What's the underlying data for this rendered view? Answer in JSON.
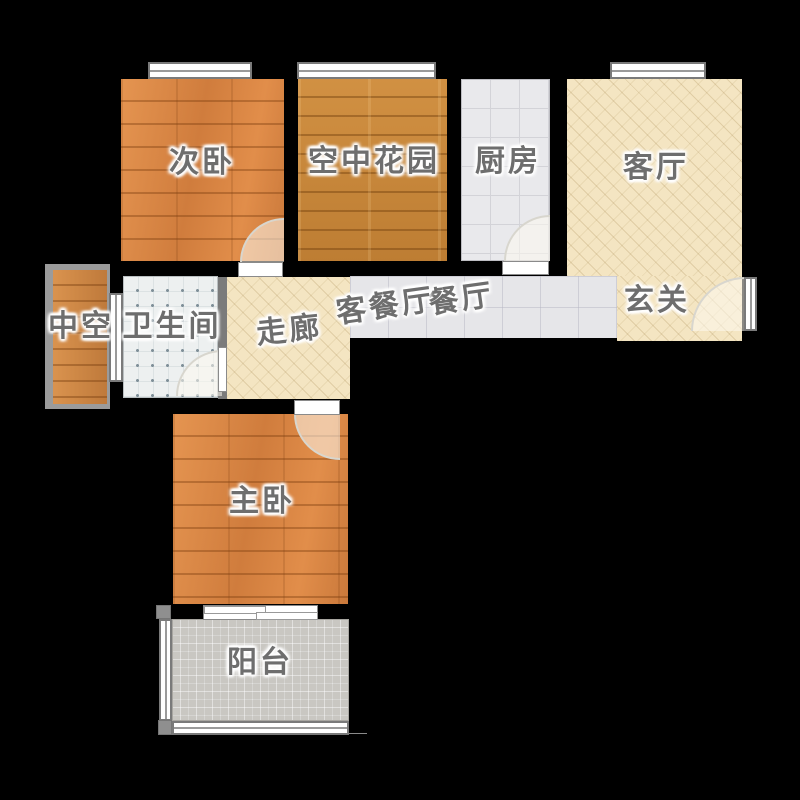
{
  "floorplan": {
    "title": "apartment-floor-plan",
    "rooms": [
      {
        "label": "次卧",
        "name": "secondary-bedroom",
        "floor": "wood-orange"
      },
      {
        "label": "空中花园",
        "name": "sky-garden",
        "floor": "wood-golden"
      },
      {
        "label": "厨房",
        "name": "kitchen",
        "floor": "tile-light-gray"
      },
      {
        "label": "客厅",
        "name": "living-room",
        "floor": "cream-hatch"
      },
      {
        "label": "玄关",
        "name": "entry-hall",
        "floor": "cream-hatch"
      },
      {
        "label": "餐厅",
        "name": "dining-room",
        "floor": "tile-light-gray"
      },
      {
        "label": "客餐厅",
        "name": "living-dining-room",
        "floor": "tile-light-gray"
      },
      {
        "label": "走廊",
        "name": "corridor",
        "floor": "cream-hatch"
      },
      {
        "label": "中空",
        "name": "void-shaft",
        "floor": "wood-orange"
      },
      {
        "label": "卫生间",
        "name": "bathroom",
        "floor": "tile-dotted"
      },
      {
        "label": "主卧",
        "name": "master-bedroom",
        "floor": "wood-orange"
      },
      {
        "label": "阳台",
        "name": "balcony",
        "floor": "tile-mosaic-gray"
      }
    ],
    "palette": {
      "background_wall": "#000000",
      "wood_orange": "#db8340",
      "wood_golden": "#c98536",
      "tile_kitchen": "#e9e9ec",
      "tile_dining": "#e6e6e9",
      "tile_bathroom": "#edf0f0",
      "cream_hatch": "#f4e5c2",
      "balcony_gray": "#c9c7c2",
      "shaft_frame_gray": "#9b9b9b",
      "opening_white": "#ffffff",
      "label_text": "#6e6e6e"
    }
  }
}
